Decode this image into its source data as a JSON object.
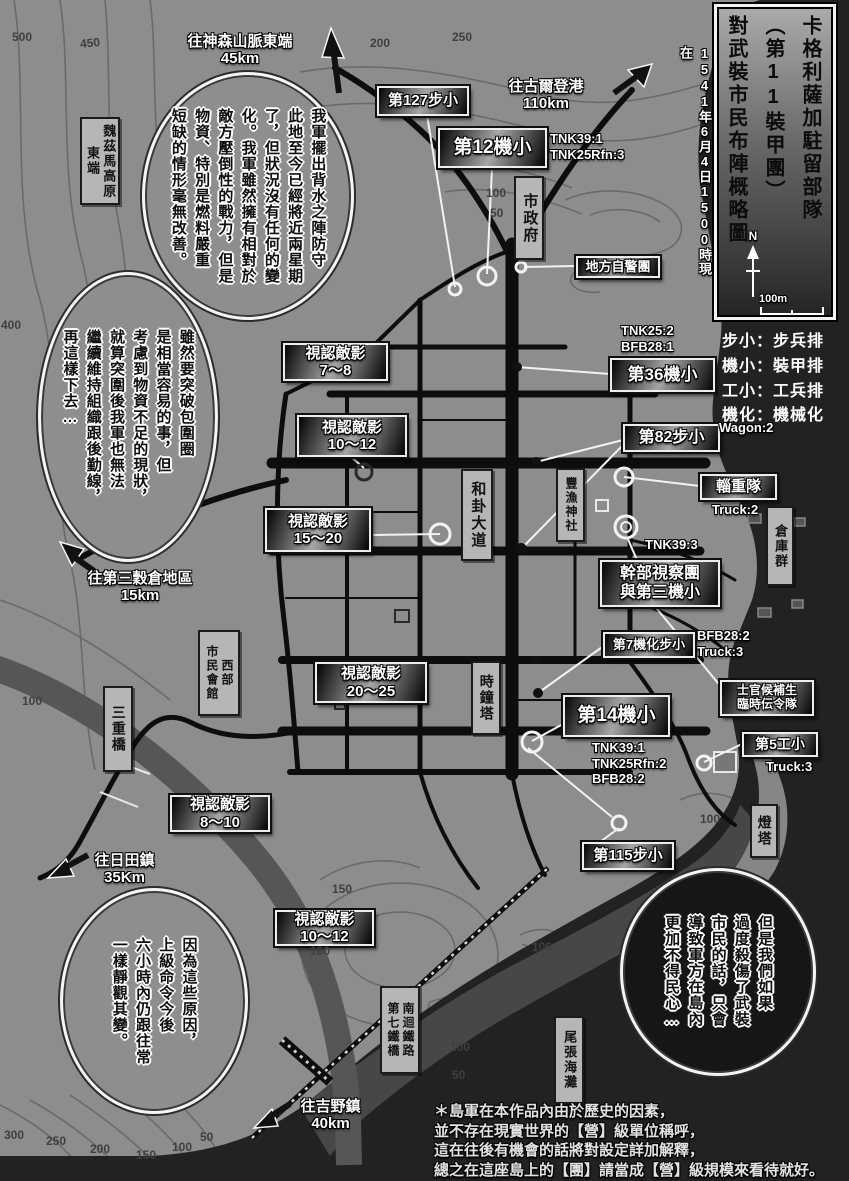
{
  "header": {
    "title": "卡格利薩加駐留部隊\n（第11裝甲團）\n對武裝市民布陣概略圖",
    "datetime": "1541年6月4日1500時現在",
    "north": "N",
    "scale": "100m"
  },
  "legend": {
    "items": [
      "步小：步兵排",
      "機小：裝甲排",
      "工小：工兵排",
      "機化：機械化"
    ]
  },
  "bubbles": {
    "supply": "我軍擺出背水之陣防守\n此地至今已經將近兩星期\n了，但狀況沒有任何的變\n化。我軍雖然擁有相對於\n敵方壓倒性的戰力，但是\n物資、特別是燃料嚴重\n短缺的情形毫無改善。",
    "breakout": "雖然要突破包圍圈\n是相當容易的事，但\n考慮到物資不足的現狀，\n就算突圍後我軍也無法\n繼續維持組織跟後勤線，\n再這樣下去…",
    "orders": "因為這些原因，\n上級命令今後\n六小時內仍跟往常\n一樣靜觀其變。",
    "civilians": "但是我們如果\n過度殺傷了武裝\n市民的話，只會\n導致軍方在島內\n更加不得民心…"
  },
  "units": {
    "u127": "第127步小",
    "u12": "第12機小",
    "militia": "地方自警團",
    "u36": "第36機小",
    "u82": "第82步小",
    "logistics": "輜重隊",
    "hq": "幹部視察團\n與第三機小",
    "u7": "第7機化步小",
    "u14": "第14機小",
    "cadet": "士官候補生\n臨時伝令隊",
    "u5": "第5工小",
    "u115": "第115步小"
  },
  "details": {
    "u12": "TNK39:1\nTNK25Rfn:3",
    "u36": "TNK25:2\nBFB28:1",
    "u82": "Wagon:2",
    "logistics": "Truck:2",
    "hq": "TNK39:3",
    "u7": "BFB28:2\nTruck:3",
    "u14": "TNK39:1\nTNK25Rfn:2\nBFB28:2",
    "u5": "Truck:3"
  },
  "sightings": {
    "s1": "視認敵影\n7～8",
    "s2": "視認敵影\n10～12",
    "s3": "視認敵影\n15～20",
    "s4": "視認敵影\n20～25",
    "s5": "視認敵影\n8～10",
    "s6": "視認敵影\n10～12"
  },
  "places": {
    "plateau": "魏茲馬高原\n東端",
    "city_hall": "市政府",
    "avenue": "和卦大道",
    "shrine": "豐漁神社",
    "warehouses": "倉庫群",
    "clock_tower": "時鐘塔",
    "civic_hall": "西部\n市民會館",
    "triple_bridge": "三重橋",
    "lighthouse": "燈塔",
    "beach": "尾張海灘",
    "rail_bridge": "南迴鐵路\n第七鐵橋"
  },
  "directions": {
    "mountains": "往神森山脈東端\n45km",
    "port": "往古爾登港\n110km",
    "granary": "往第三穀倉地區\n15km",
    "hida": "往日田鎮\n35Km",
    "yoshino": "往吉野鎮\n40km"
  },
  "contour_labels": [
    "500",
    "450",
    "200",
    "250",
    "400",
    "100",
    "50",
    "100",
    "150",
    "100",
    "100",
    "100",
    "50",
    "100",
    "300",
    "250",
    "200",
    "150",
    "100",
    "50"
  ],
  "footnote": "＊島軍在本作品內由於歷史的因素，\n並不存在現實世界的【營】級單位稱呼，\n這在往後有機會的話將對設定詳加解釋，\n總之在這座島上的【團】請當成【營】級規模來看待就好。"
}
